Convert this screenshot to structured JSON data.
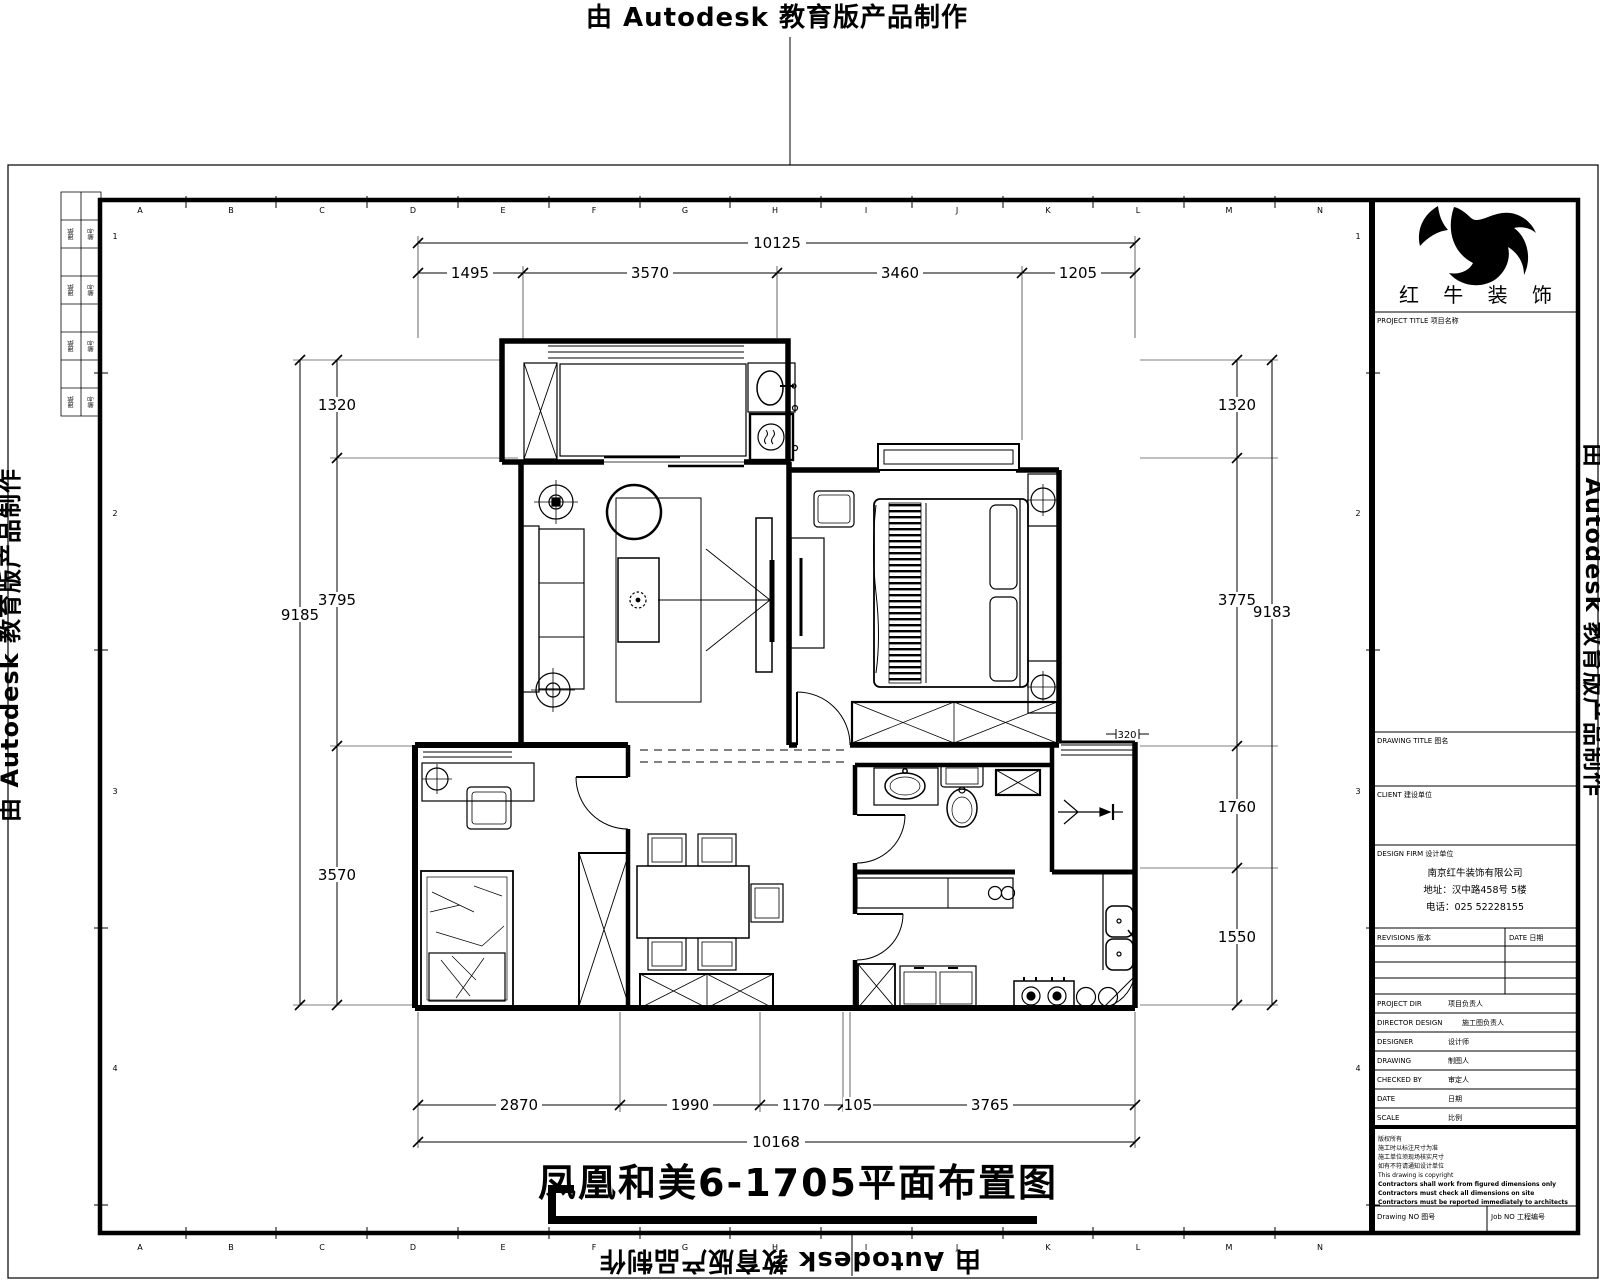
{
  "banner": "由 Autodesk 教育版产品制作",
  "sheet_title": "凤凰和美6-1705平面布置图",
  "grid": {
    "cols": [
      "A",
      "B",
      "C",
      "D",
      "E",
      "F",
      "G",
      "H",
      "I",
      "J",
      "K",
      "L",
      "M",
      "N"
    ],
    "rows": [
      "1",
      "2",
      "3",
      "4"
    ]
  },
  "dims": {
    "top": {
      "overall": "10125",
      "segments": [
        "1495",
        "3570",
        "3460",
        "1205"
      ]
    },
    "bottom": {
      "overall": "10168",
      "segments": [
        "2870",
        "1990",
        "1170",
        "105",
        "3765"
      ]
    },
    "left": {
      "overall": "9185",
      "segments": [
        "1320",
        "3795",
        "3570"
      ]
    },
    "right": {
      "overall": "9183",
      "segments": [
        "1320",
        "3775",
        "1760",
        "1550"
      ]
    },
    "level_marker": "320"
  },
  "edge_table": {
    "rows": [
      {
        "c1": "图纸",
        "c2": "编号"
      },
      {
        "c1": "图纸",
        "c2": "编号"
      },
      {
        "c1": "图纸",
        "c2": "编号"
      },
      {
        "c1": "图纸",
        "c2": "编号"
      }
    ]
  },
  "title_block": {
    "brand": "红 牛 装 饰",
    "project_title_label": "PROJECT TITLE 项目名称",
    "drawing_title_label": "DRAWING TITLE 图名",
    "client_label": "CLIENT 建设单位",
    "design_firm_label": "DESIGN FIRM 设计单位",
    "firm_lines": [
      "南京红牛装饰有限公司",
      "地址：汉中路458号 5楼",
      "电话：025 52228155"
    ],
    "revisions_label": "REVISIONS 版本",
    "date_col_label": "DATE 日期",
    "rows": [
      {
        "en": "PROJECT DIR",
        "cn": "项目负责人"
      },
      {
        "en": "DIRECTOR DESIGN",
        "cn": "施工图负责人"
      },
      {
        "en": "DESIGNER",
        "cn": "设计师"
      },
      {
        "en": "DRAWING",
        "cn": "制图人"
      },
      {
        "en": "CHECKED BY",
        "cn": "审定人"
      },
      {
        "en": "DATE",
        "cn": "日期"
      },
      {
        "en": "SCALE",
        "cn": "比例"
      }
    ],
    "notes": [
      "版权所有",
      "施工时以标注尺寸为准",
      "施工单位须现场核实尺寸",
      "如有不符请通知设计单位",
      "This drawing is copyright",
      "Contractors shall work from figured dimensions only",
      "Contractors must check all dimensions on site",
      "Contractors must be reported immediately to architects"
    ],
    "footer": {
      "drawing_no": "Drawing NO 图号",
      "job_no": "Job NO 工程编号"
    }
  }
}
